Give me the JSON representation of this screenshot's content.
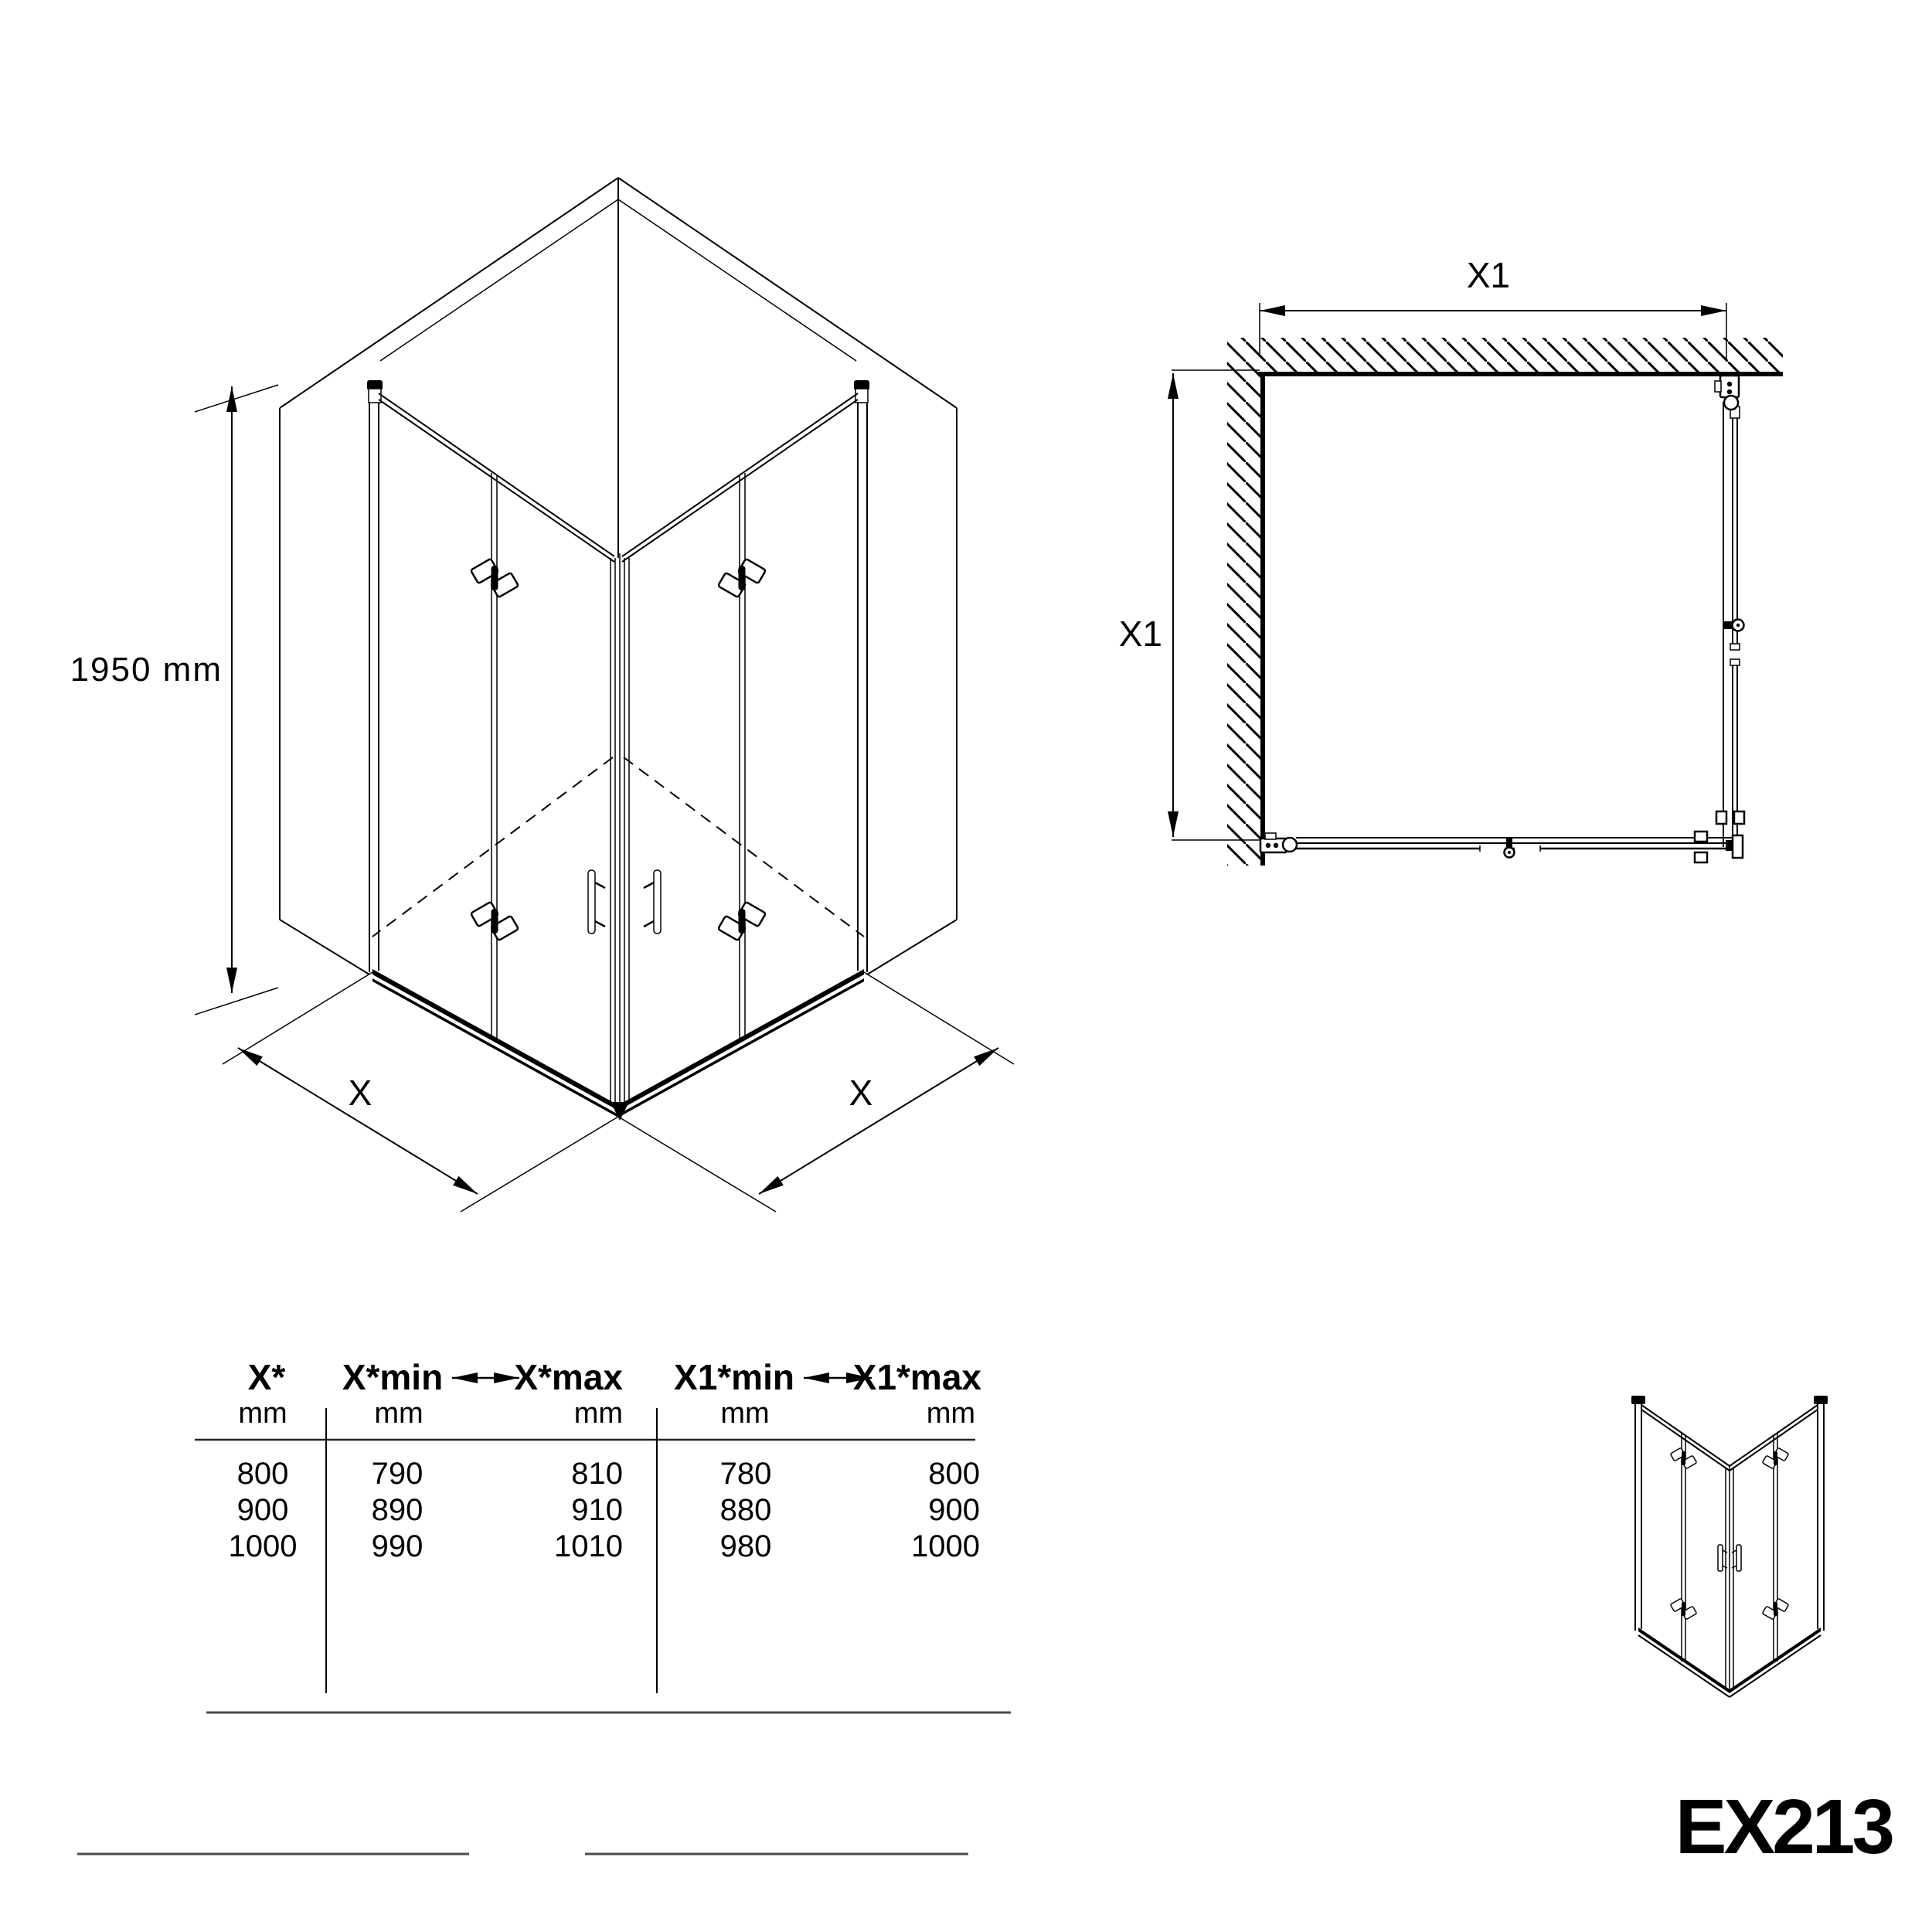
{
  "drawing": {
    "iso": {
      "height": "1950 mm",
      "width_left": "X",
      "width_right": "X"
    },
    "plan": {
      "width": "X1",
      "depth": "X1"
    },
    "table": {
      "col1": {
        "header": "X*",
        "unit": "mm"
      },
      "col2": {
        "header": "X*min",
        "unit": "mm"
      },
      "col3": {
        "header": "X*max",
        "unit": "mm"
      },
      "col4": {
        "header": "X1*min",
        "unit": "mm"
      },
      "col5": {
        "header": "X1*max",
        "unit": "mm"
      },
      "rows": [
        {
          "x": "800",
          "xmin": "790",
          "xmax": "810",
          "x1min": "780",
          "x1max": "800"
        },
        {
          "x": "900",
          "xmin": "890",
          "xmax": "910",
          "x1min": "880",
          "x1max": "900"
        },
        {
          "x": "1000",
          "xmin": "990",
          "xmax": "1010",
          "x1min": "980",
          "x1max": "1000"
        }
      ]
    },
    "model": "EX213"
  },
  "colors": {
    "line": "#000000",
    "divider": "#4a4a4a"
  }
}
